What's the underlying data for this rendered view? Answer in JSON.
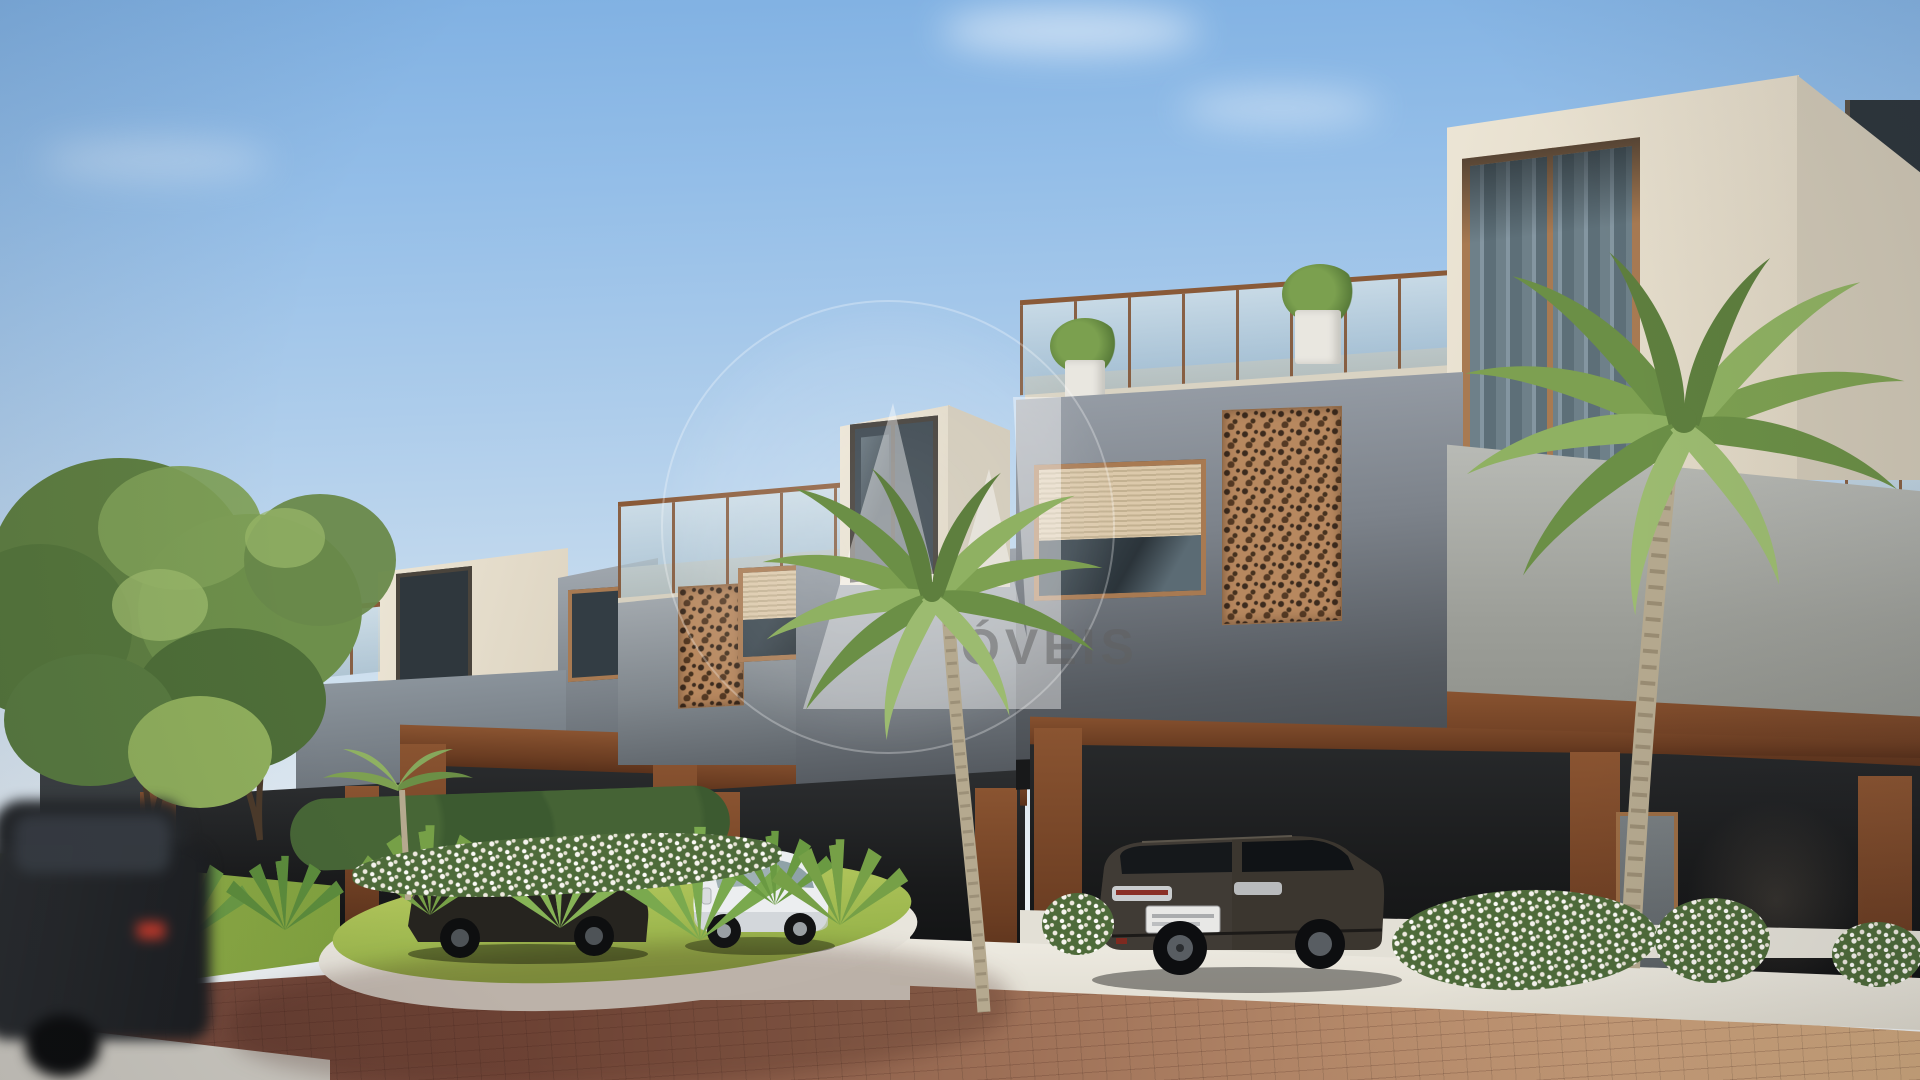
{
  "watermark": {
    "text": "ÓVEIS",
    "logo": "circle-monogram"
  },
  "scene": {
    "description": "3D architectural rendering of a row of modern two-storey townhouses with rooftop terraces, glass railings, perforated corten-steel screens and carports, along a brick-paved street with palm trees, landscaped island and parked cars",
    "objects": [
      "sky",
      "clouds",
      "townhouse-row",
      "rooftop-terrace",
      "glass-railing",
      "copper-framed-windows",
      "perforated-corten-panels",
      "roller-shutter-windows",
      "carports",
      "entry-door",
      "palm-trees",
      "street-trees",
      "hedge",
      "landscaped-island",
      "white-flower-bushes",
      "fan-palms",
      "grass-verge",
      "brick-paved-road",
      "concrete-sidewalk",
      "driveway-aprons",
      "curb",
      "dark-suv",
      "white-hatchback",
      "dark-sedan",
      "motion-blurred-car",
      "watermark"
    ],
    "palette": {
      "sky_top": "#7fb0e2",
      "sky_horizon": "#f1f3f2",
      "wall_cream": "#e9e2d2",
      "wall_gray_light": "#9aa1aa",
      "wall_gray_dark": "#43474c",
      "corten": "#7c4a2c",
      "copper_frame": "#a87a52",
      "glass_curtain": "#6e8089",
      "palm_green": "#7fa052",
      "grass": "#9cb84e",
      "road_left_brick": "#6e4438",
      "road_right_brick": "#c59b77",
      "concrete": "#ece9e0",
      "carport_shadow": "#1a1b1c"
    }
  }
}
